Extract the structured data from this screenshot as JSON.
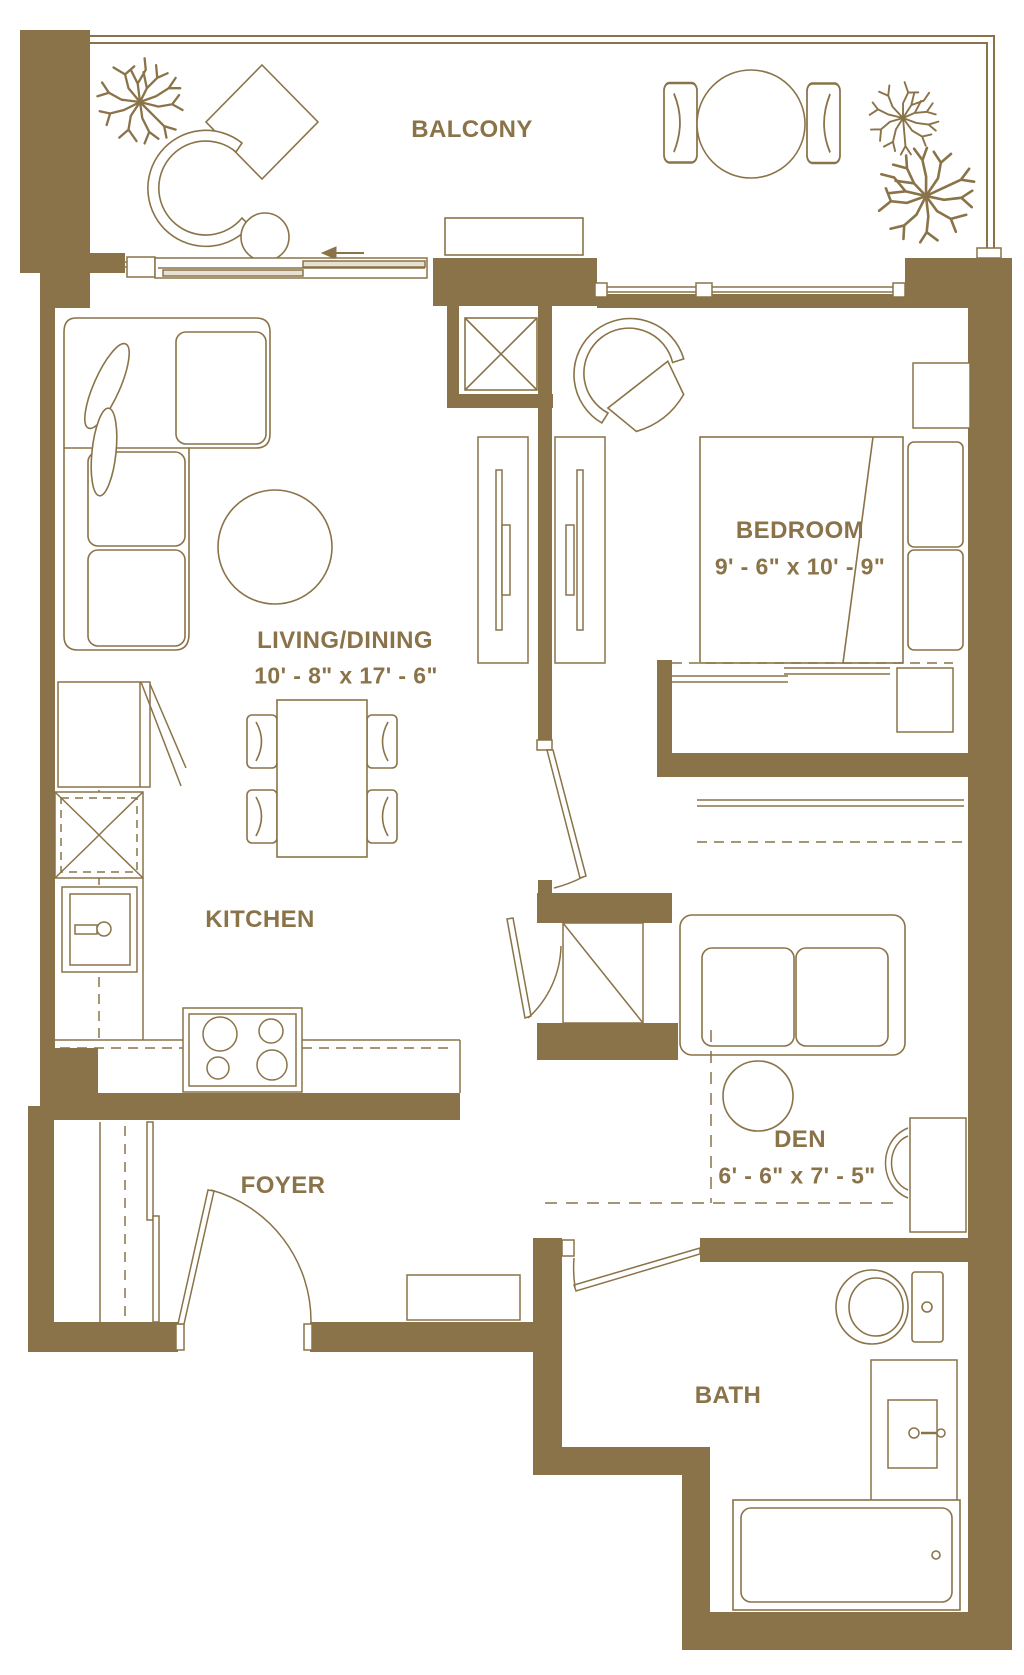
{
  "plan": {
    "title": "Floor plan",
    "wall_color": "#8a7348",
    "line_color": "#8a7348",
    "background_color": "#ffffff"
  },
  "rooms": {
    "balcony": {
      "label": "BALCONY"
    },
    "living_dining": {
      "label": "LIVING/DINING",
      "dimensions": "10' - 8\" x 17' - 6\""
    },
    "bedroom": {
      "label": "BEDROOM",
      "dimensions": "9' - 6\" x 10' - 9\""
    },
    "kitchen": {
      "label": "KITCHEN"
    },
    "den": {
      "label": "DEN",
      "dimensions": "6' - 6\" x 7' - 5\""
    },
    "foyer": {
      "label": "FOYER"
    },
    "bath": {
      "label": "BATH"
    }
  }
}
